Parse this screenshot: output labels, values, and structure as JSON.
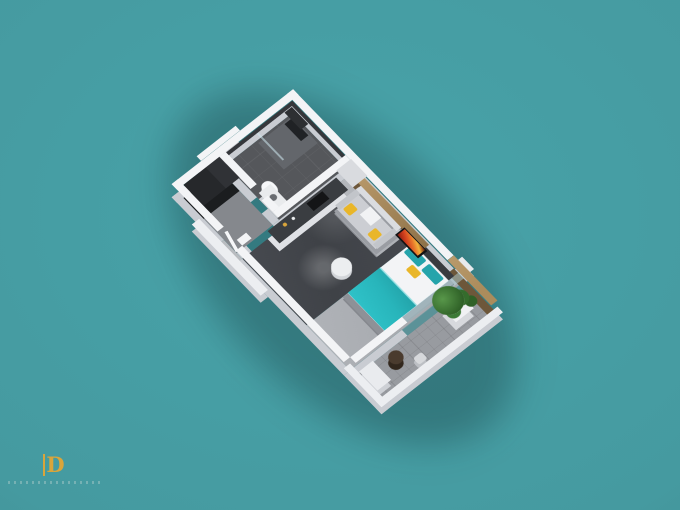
{
  "scene": {
    "title": "studio-apartment-3d-floor-plan-render",
    "view": "isometric-top-down",
    "rooms": [
      "bathroom",
      "entry-hallway",
      "kitchenette",
      "living-area",
      "sleeping-area",
      "balcony"
    ],
    "objects": [
      "wardrobe",
      "shower",
      "toilet",
      "vanity",
      "kitchen-counter",
      "cooktop",
      "fridge-cabinet",
      "sofa",
      "yellow-pillows",
      "tv-on-wood-panel",
      "round-pouf",
      "double-bed",
      "teal-duvet",
      "teal-pillows",
      "yellow-accent-pillow",
      "headboard",
      "balcony-plant",
      "round-table",
      "stool",
      "balcony-cabinet",
      "wood-feature-wall"
    ]
  },
  "colors": {
    "teal_center": "#48a3a9",
    "teal_edge": "#3e7e83",
    "wall_top": "#f3f4f6",
    "wall_side": "#c9ccd2",
    "wall_low_top": "#eceef1",
    "bath_floor": "#55575b",
    "bath_wall_tile": "#35373b",
    "corridor_floor": "#85888d",
    "living_floor": "#3f4247",
    "bedroom_carpet": "#a7aaaf",
    "balcony_floor": "#989ba0",
    "wood_top": "#ab8c5c",
    "wood_side": "#6d573a",
    "counter_top": "#3a3d41",
    "cabinet_white": "#dfe1e5",
    "sofa_gray": "#ccced3",
    "accent_yellow": "#e9b629",
    "bed_white": "#f3f4f6",
    "accent_teal": "#28b5bb",
    "plant_green": "#3c7a36",
    "pot_white": "#f0f1f3",
    "tv_frame": "#121315",
    "logo_gold": "#d9a53b"
  },
  "logo": {
    "monogram": "D"
  }
}
